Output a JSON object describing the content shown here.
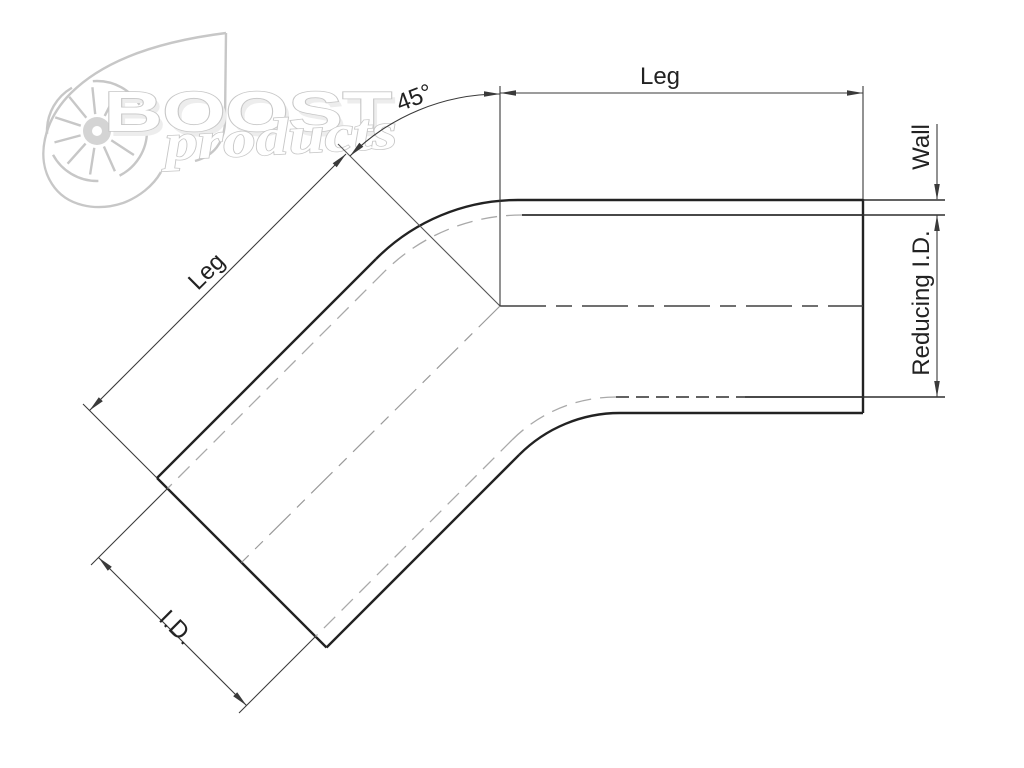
{
  "title": "45 degree reducer elbow dimension drawing",
  "watermark": {
    "brand": "BOOST",
    "sub": "products"
  },
  "labels": {
    "leg_top": "Leg",
    "leg_diagonal": "Leg",
    "wall": "Wall",
    "reducing_id": "Reducing I.D.",
    "id": "I.D.",
    "angle": "45°"
  },
  "colors": {
    "ink": "#222222",
    "mid": "#2e2e2e",
    "dim": "#3a3a3a",
    "lt": "#a9a9a9",
    "cl": "#404040",
    "cld": "#9a9a9a",
    "wm": "#c7c7c7",
    "wmfill": "#ededed"
  }
}
